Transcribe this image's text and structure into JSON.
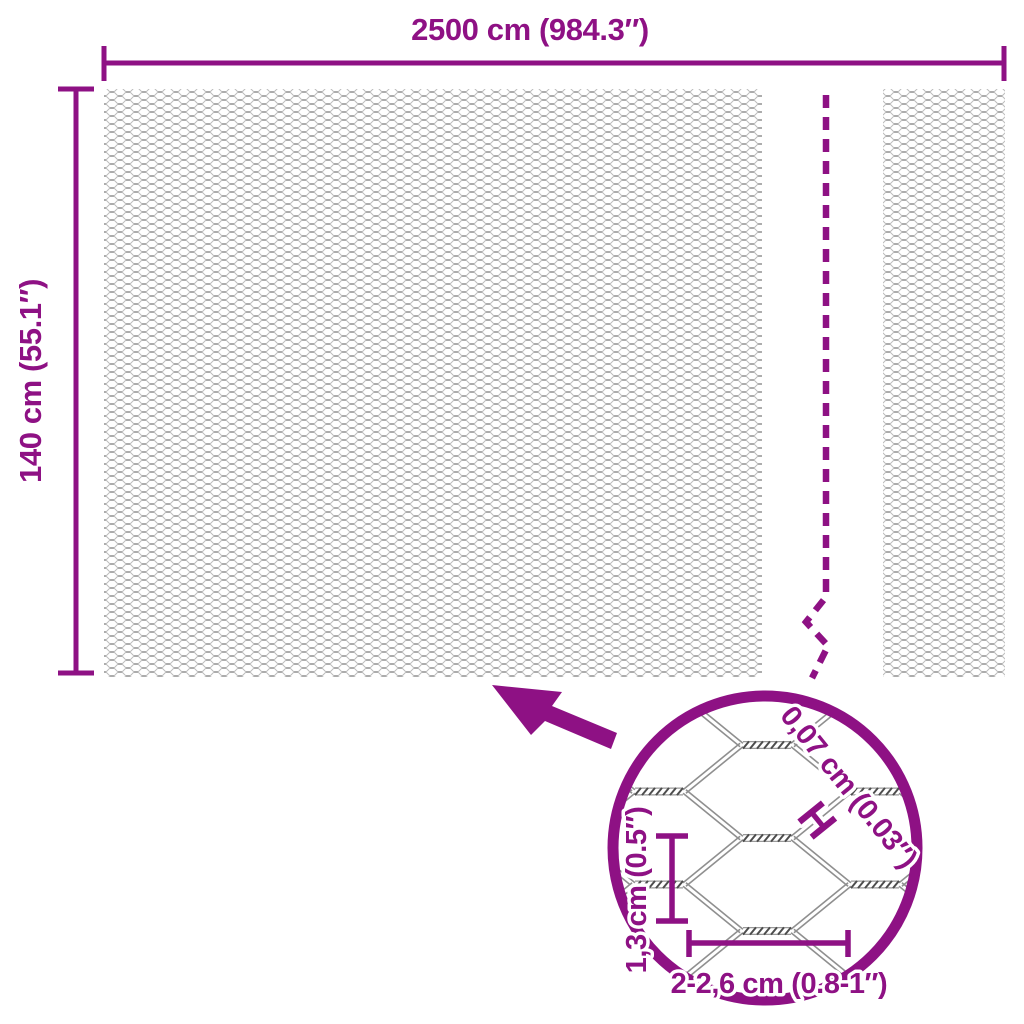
{
  "diagram": {
    "width_label": "2500 cm (984.3″)",
    "height_label": "140 cm (55.1″)",
    "detail": {
      "wire_gauge_label": "0,07 cm (0.03″)",
      "wire_gauge_marker": "H",
      "cell_height_label": "1,3 cm (0.5″)",
      "cell_width_label": "2-2,6 cm (0.8-1″)"
    },
    "colors": {
      "accent": "#8E1184",
      "mesh_fine_gray": "#bcbcbc",
      "mesh_detail_gray": "#8f8f8f",
      "background": "#ffffff"
    }
  }
}
